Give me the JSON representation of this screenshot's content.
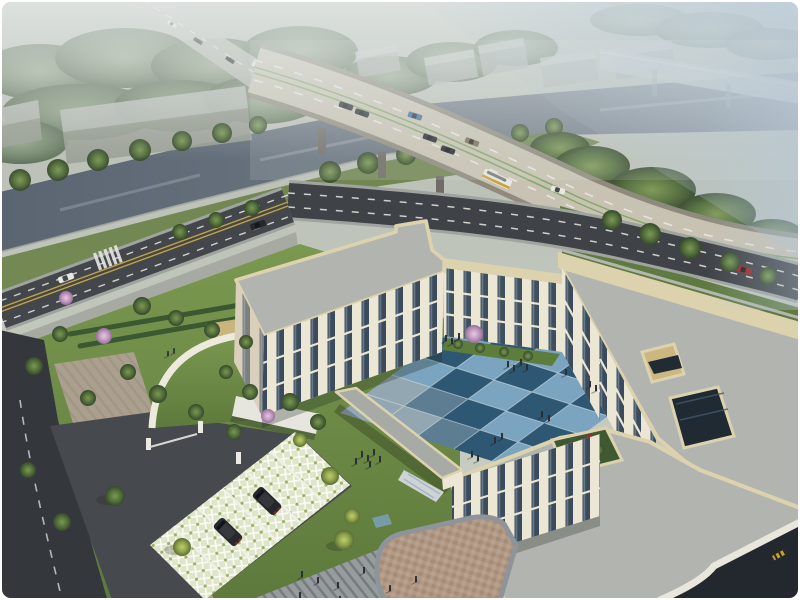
{
  "image": {
    "type": "architectural-aerial-rendering",
    "width": 800,
    "height": 600
  },
  "scene": {
    "setting": "Hazy aerial rendering of a cream three-story U-shaped building complex with a blue checker-tiled courtyard, landscaped grounds, a curved highway bridge over a canal behind, and streets with parking in the foreground",
    "background": {
      "weather": "overcast haze",
      "canal": true,
      "highway_bridge": true,
      "second_distant_viaduct": true,
      "gray_warehouses": 2,
      "distant_block_buildings": 5,
      "dense_tree_belts": true
    },
    "site": {
      "building_floors": 3,
      "courtyard_tile_colors": [
        "light blue",
        "dark blue",
        "pale gray-blue"
      ],
      "green_roof_gatehouse": true,
      "rooftop_garden": true,
      "rooftop_atrium_opening": true,
      "grass_paver_parking_stalls": 6,
      "pink_blossom_trees": 4,
      "pedestrian_groups": [
        "courtyard",
        "west plaza",
        "south plaza",
        "north lawn"
      ]
    },
    "vehicles": {
      "bridge": [
        "dark car",
        "dark car",
        "blue car",
        "dark car",
        "dark car",
        "tan car",
        "white bus with yellow stripe",
        "white car"
      ],
      "northeast_road": [
        "red car",
        "red car"
      ],
      "west_street": [
        "dark car",
        "white car"
      ],
      "approach_road": [
        "white car",
        "dark car",
        "dark car"
      ],
      "parking": [
        "dark suv",
        "dark suv"
      ]
    }
  },
  "palette": {
    "wall": "#ece6d4",
    "wallShade": "#d9cfba",
    "parapet": "#ddd2ae",
    "roofPaver": "#b2b4af",
    "glass": "#2c3e50",
    "bridgeDeck": "#c8c2b2",
    "bridgeEdge": "#8f8a7d",
    "roadDark": "#3f4247",
    "roadBottom": "#34373c",
    "laneWhite": "#e9e9e4",
    "laneYellow": "#bfa244",
    "laneGreen": "#7ca463",
    "sidewalk": "#a7aaa3",
    "tanPaving": "#ab9f8d",
    "tileLight": "#7ba4c0",
    "tileDark": "#2e5774",
    "tileGray": "#93a7b3",
    "plaza": "#979c9e",
    "lattice": "#dfe5c9",
    "lawnLight": "#7b9850",
    "lawnDark": "#5d7a3c",
    "water": "#67727e",
    "blossom": "#c79fc5",
    "carRed": "#942a24",
    "carBlue": "#41699b",
    "carDark": "#24272c",
    "carWhite": "#e8e8e2",
    "busYellow": "#c8a23b",
    "tanCourt": "#cdb780",
    "people": "#2b2e33",
    "hazeBlue": "#b2c4d4",
    "frame": "#ffffff"
  }
}
